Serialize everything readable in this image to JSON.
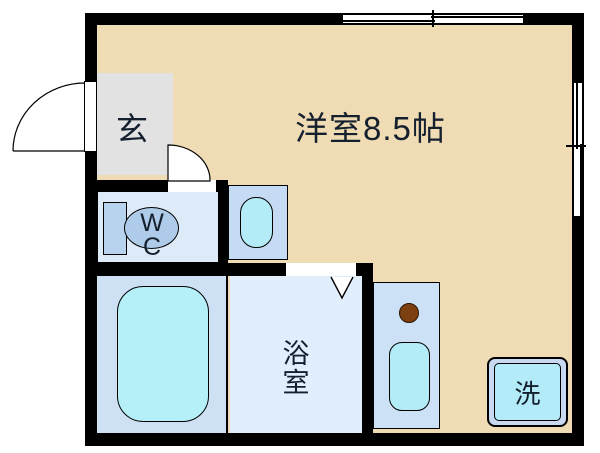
{
  "plan": {
    "rooms": {
      "main_room": {
        "label": "洋室8.5帖"
      },
      "entrance": {
        "label": "玄"
      },
      "toilet": {
        "label_top": "W",
        "label_bottom": "C"
      },
      "bathroom": {
        "label_top": "浴",
        "label_bottom": "室"
      },
      "laundry": {
        "label": "洗"
      }
    },
    "colors": {
      "wall": "#000000",
      "main_floor": "#f0dcb4",
      "entrance_floor": "#e2e2e3",
      "wc_floor": "#ddeaf8",
      "tub_room_floor": "#cde0f4",
      "bathroom_floor": "#e1eefb",
      "fixture_panel": "#c5daf3",
      "fixture_basin": "#b3ecf6",
      "toilet_fill": "#b7d3ee",
      "burner": "#7c3f10"
    }
  }
}
